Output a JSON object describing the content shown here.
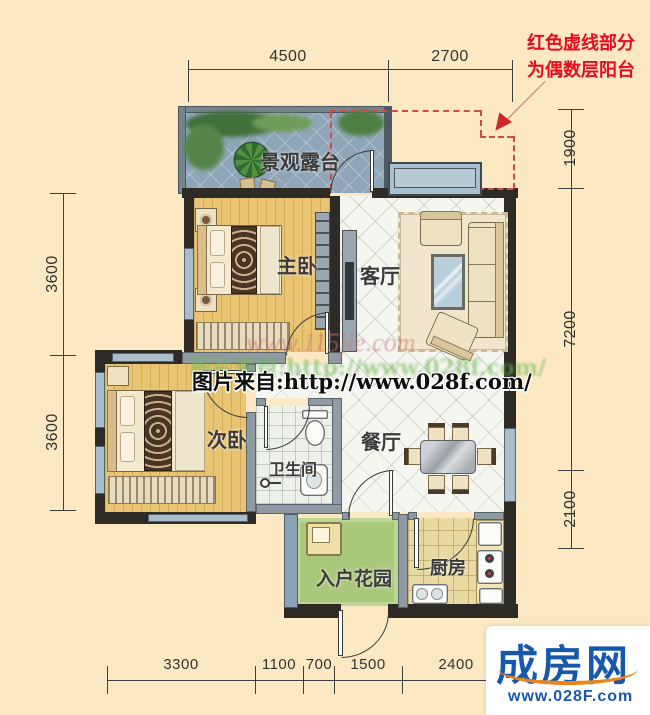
{
  "annotation": {
    "line1": "红色虚线部分",
    "line2": "为偶数层阳台"
  },
  "dimensions": {
    "top": [
      "4500",
      "2700"
    ],
    "right": [
      "1900",
      "7200",
      "2100"
    ],
    "left": [
      "3600",
      "3600"
    ],
    "bottom": [
      "3300",
      "1100",
      "700",
      "1500",
      "2400"
    ]
  },
  "rooms": {
    "terrace": "景观露台",
    "master_bedroom": "主卧",
    "living_room": "客厅",
    "second_bedroom": "次卧",
    "bathroom": "卫生间",
    "dining_room": "餐厅",
    "entry_garden": "入户花园",
    "kitchen": "厨房"
  },
  "watermarks": {
    "site_faint": "www.115jie.com",
    "source_green": "图片来自:http://www.028f.com/",
    "source_main": "图片来自:http://www.028f.com/"
  },
  "logo": {
    "brand": "成房网",
    "url": "www.028F.com"
  },
  "colors": {
    "background": "#fce9c4",
    "wall": "#2e2a25",
    "partition": "#8f9aa3",
    "balcony_dash": "#d24a42",
    "annotation_red": "#e60b1e",
    "logo_blue": "#1758ad",
    "logo_orange": "#e8861c"
  }
}
